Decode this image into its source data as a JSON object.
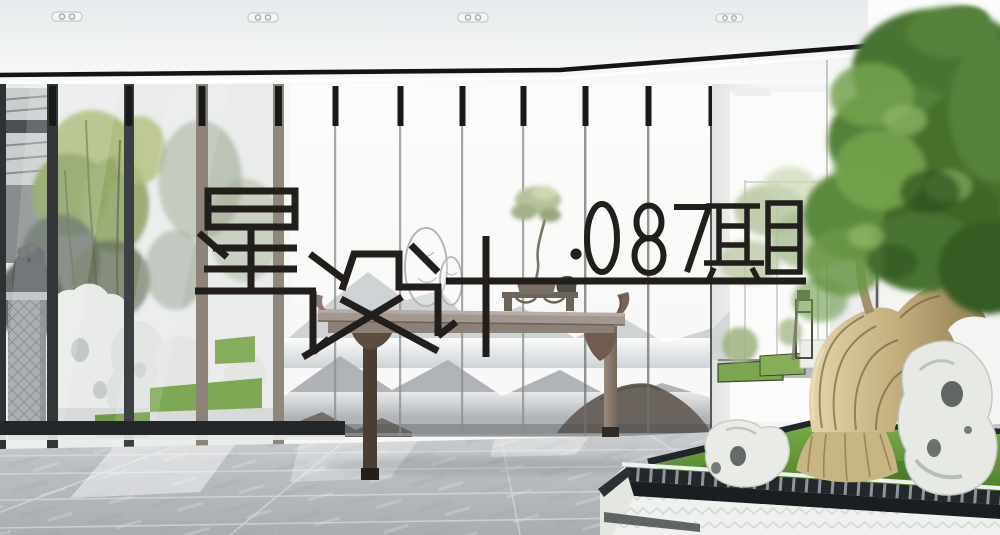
{
  "overlay": {
    "title": "星设计",
    "issue": "·087期",
    "title_full": "星设计 ·087期",
    "title_color": "#221e1c",
    "underline_color": "#221e1c"
  },
  "scene": {
    "description": "New Chinese style interior: ink-wash mountain mural on sliding glass panels, altar console table with bonsai penjing, courtyard with stone lion and taihu rocks, indoor gnarled tree in a raised stone planter, grey tiled floor, white ceiling with recessed downlights",
    "elements": [
      "ceiling-downlights",
      "black-ceiling-reveal",
      "left-courtyard-glass-wall",
      "stone-lion-statue",
      "taihu-white-rocks",
      "bamboo-foliage",
      "ink-mountain-mural-panels",
      "round-fan-decorations",
      "altar-console-table",
      "bonsai-penjing-on-stand",
      "right-corridor-courtyard",
      "indoor-gnarled-tree",
      "raised-stone-planter-with-moss",
      "grey-tile-floor"
    ]
  },
  "palette": {
    "foliage_green": "#4d7631",
    "moss_green": "#64a13b",
    "trunk_tan": "#cbbd92",
    "mural_grey": "#a9aeb2",
    "mural_dark": "#6f6963",
    "floor_grey": "#b7bbbf",
    "table_wood": "#9a8c83",
    "frame_dark": "#33373a",
    "metal_black": "#17191b",
    "wall_white": "#f2f3f1"
  }
}
